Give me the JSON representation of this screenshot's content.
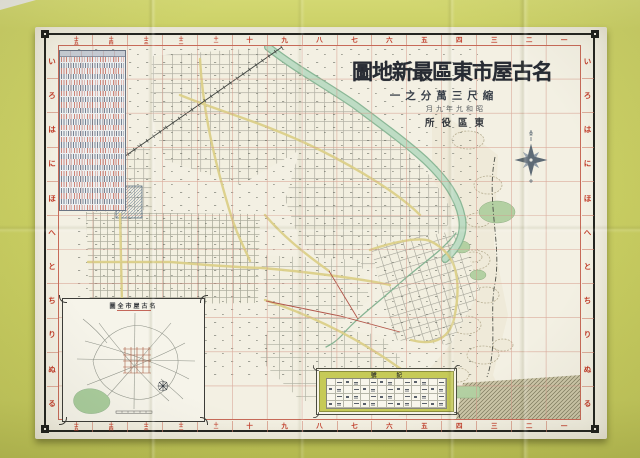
{
  "title_block": {
    "title_display": "圖地新最區東市屋古名",
    "scale_display": "一之分萬三尺縮",
    "date_display": "月九年九和昭",
    "publisher_display": "所役區東"
  },
  "border": {
    "numbers": [
      "十五",
      "十四",
      "十三",
      "十二",
      "十一",
      "十",
      "九",
      "八",
      "七",
      "六",
      "五",
      "四",
      "三",
      "二",
      "一"
    ],
    "kana": [
      "い",
      "ろ",
      "は",
      "に",
      "ほ",
      "へ",
      "と",
      "ち",
      "り",
      "ぬ",
      "る"
    ]
  },
  "inset": {
    "title_display": "圖全市屋古名"
  },
  "legend": {
    "title_display": "號記",
    "rows": 4,
    "cols": 14
  },
  "index_table": {
    "row_count": 27
  },
  "colors": {
    "backdrop": "#c9ce62",
    "sheet": "#f3f0e3",
    "frame_black": "#23241f",
    "grid_red": "#c76a58",
    "label_red": "#c03b28",
    "river_green": "#8ab796",
    "park_green": "#b3d0a2",
    "road_yellow": "#dcd089",
    "compass_slate": "#5d6a75"
  }
}
